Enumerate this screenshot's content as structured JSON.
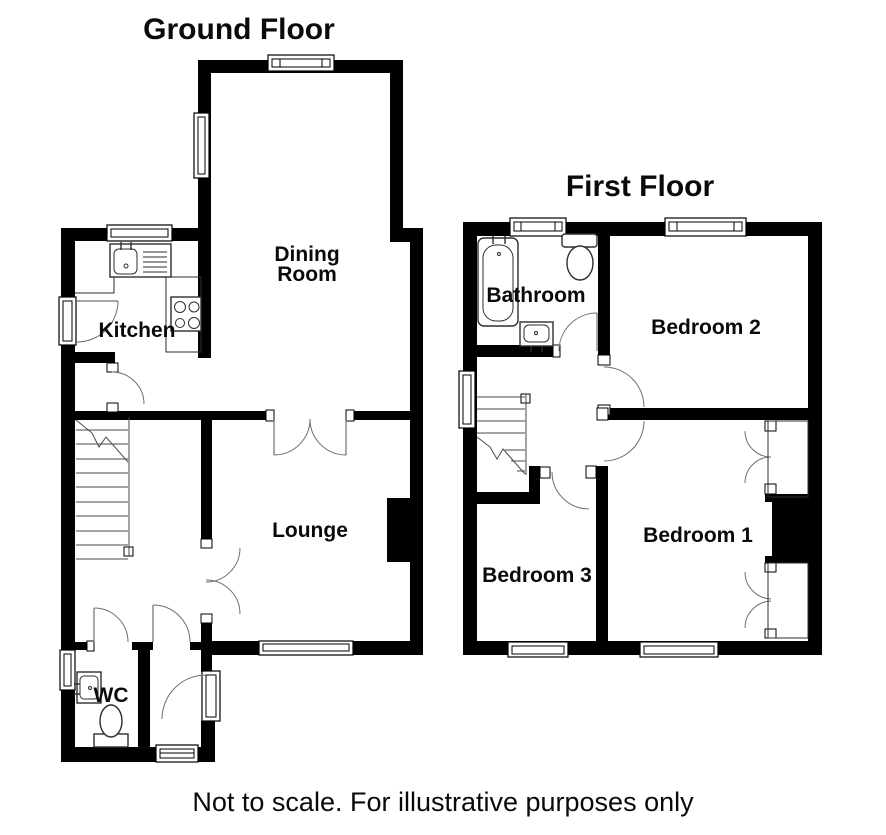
{
  "ground_floor": {
    "title": "Ground Floor",
    "rooms": {
      "dining_line1": "Dining",
      "dining_line2": "Room",
      "kitchen": "Kitchen",
      "lounge": "Lounge",
      "wc": "WC"
    }
  },
  "first_floor": {
    "title": "First Floor",
    "rooms": {
      "bathroom": "Bathroom",
      "bedroom2": "Bedroom 2",
      "bedroom1": "Bedroom 1",
      "bedroom3": "Bedroom 3"
    }
  },
  "caption": "Not to scale. For illustrative purposes only",
  "colors": {
    "wall": "#000000",
    "background": "#ffffff",
    "door_arc": "#6f6f6f"
  }
}
